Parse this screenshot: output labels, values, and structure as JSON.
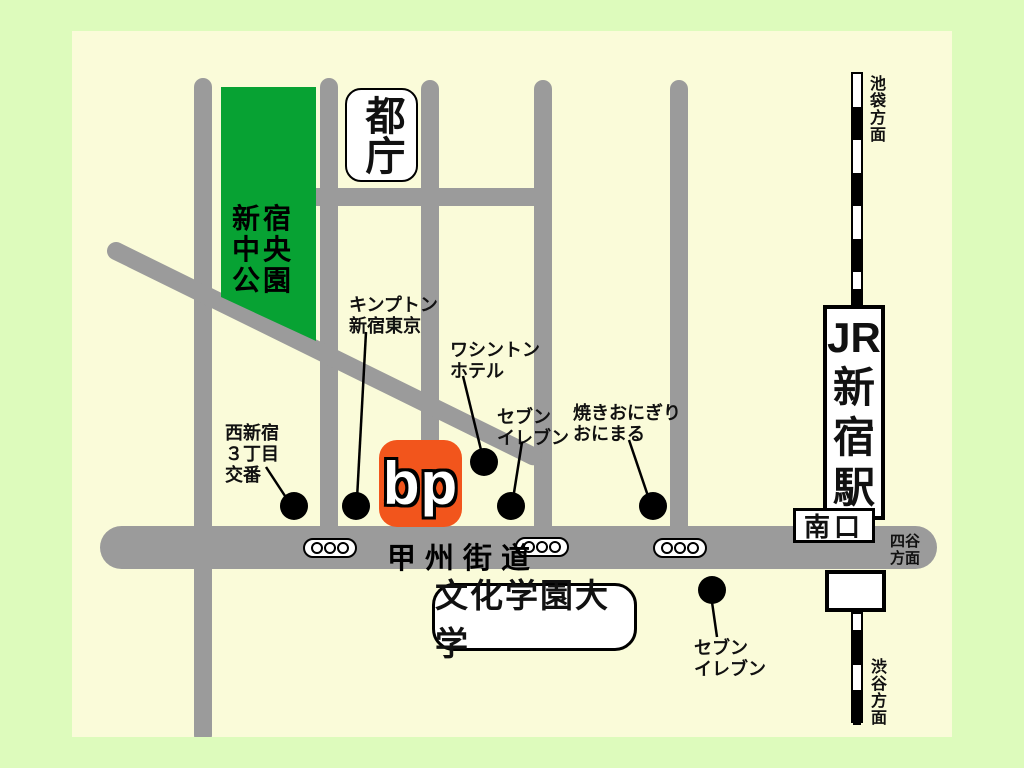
{
  "colors": {
    "outer_bg": "#ddfbbc",
    "map_bg": "#fafbd9",
    "road": "#9b9b9b",
    "park_green": "#07a233",
    "bp_orange": "#f2551c"
  },
  "park": {
    "line1": "新宿",
    "line2": "中央",
    "line3": "公園"
  },
  "tocho": {
    "label": "都庁"
  },
  "station": {
    "jr": "JR",
    "c1": "新",
    "c2": "宿",
    "c3": "駅",
    "south_exit": "南口"
  },
  "directions": {
    "ikebukuro": "池袋方面",
    "shibuya": "渋谷方面",
    "yotsuya1": "四谷",
    "yotsuya2": "方面",
    "hatsudai1": "初台",
    "hatsudai2": "方面"
  },
  "roads": {
    "koshu_kaido": "甲州街道"
  },
  "bp": {
    "label": "bp"
  },
  "university": {
    "label": "文化学園大学"
  },
  "landmarks": {
    "koban": {
      "l1": "西新宿",
      "l2": "３丁目",
      "l3": "交番"
    },
    "kimpton": {
      "l1": "キンプトン",
      "l2": "新宿東京"
    },
    "washington": {
      "l1": "ワシントン",
      "l2": "ホテル"
    },
    "seven_north": {
      "l1": "セブン",
      "l2": "イレブン"
    },
    "onimaru": {
      "l1": "焼きおにぎり",
      "l2": "おにまる"
    },
    "seven_south": {
      "l1": "セブン",
      "l2": "イレブン"
    }
  }
}
